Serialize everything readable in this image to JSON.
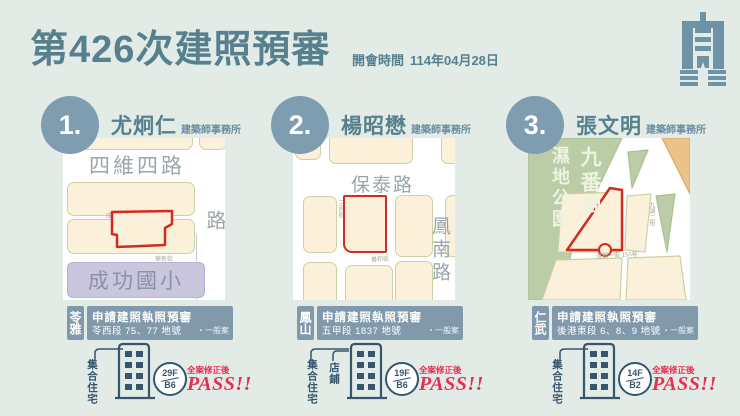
{
  "header": {
    "title": "第426次建照預審",
    "meeting_label": "開會時間",
    "meeting_date": "114年04月28日"
  },
  "colors": {
    "accent": "#57808f",
    "circle_blue": "#7e9db1",
    "bar_slate": "#8099ab",
    "plot_red": "#d42a20",
    "pass_red": "#e82e53",
    "block_cream": "#fbf0da",
    "park_green": "#bacda6",
    "school_purple": "#c9c6dd"
  },
  "cards": [
    {
      "number": "1.",
      "architect": "尤炯仁",
      "firm": "建築師事務所",
      "district": "苓雅",
      "case_title": "申請建照執照預審",
      "lot": "苓西段 75、77 地號",
      "review": "・一般案",
      "uses": [
        "集合住宅"
      ],
      "floors_up": "29F",
      "floors_down": "B6",
      "note": "全案修正後",
      "result": "PASS!!",
      "map": {
        "road_top": "四維四路",
        "road_right": "成功一路",
        "lane_top": "成功一巷 55巷",
        "lane_bottom": "華新街",
        "landmark": "成功國小"
      }
    },
    {
      "number": "2.",
      "architect": "楊昭懋",
      "firm": "建築師事務所",
      "district": "鳳山",
      "case_title": "申請建照執照預審",
      "lot": "五甲段 1837 地號",
      "review": "・一般案",
      "uses": [
        "集合住宅",
        "店鋪"
      ],
      "floors_up": "19F",
      "floors_down": "B6",
      "note": "全案修正後",
      "result": "PASS!!",
      "map": {
        "road_top": "保泰路",
        "road_right": "鳳南路",
        "lane_left": "三自街",
        "lane_bottom": "善和街"
      }
    },
    {
      "number": "3.",
      "architect": "張文明",
      "firm": "建築師事務所",
      "district": "仁武",
      "case_title": "申請建照執照預審",
      "lot": "後港東段 6、8、9 地號",
      "review": "・一般案",
      "uses": [
        "集合住宅"
      ],
      "floors_up": "14F",
      "floors_down": "B2",
      "note": "全案修正後",
      "result": "PASS!!",
      "map": {
        "park_name_1": "九番埤",
        "park_name_2": "濕地公園",
        "lane_right": "九湖二街",
        "lane_bottom": "澄觀一街 155巷"
      }
    }
  ]
}
